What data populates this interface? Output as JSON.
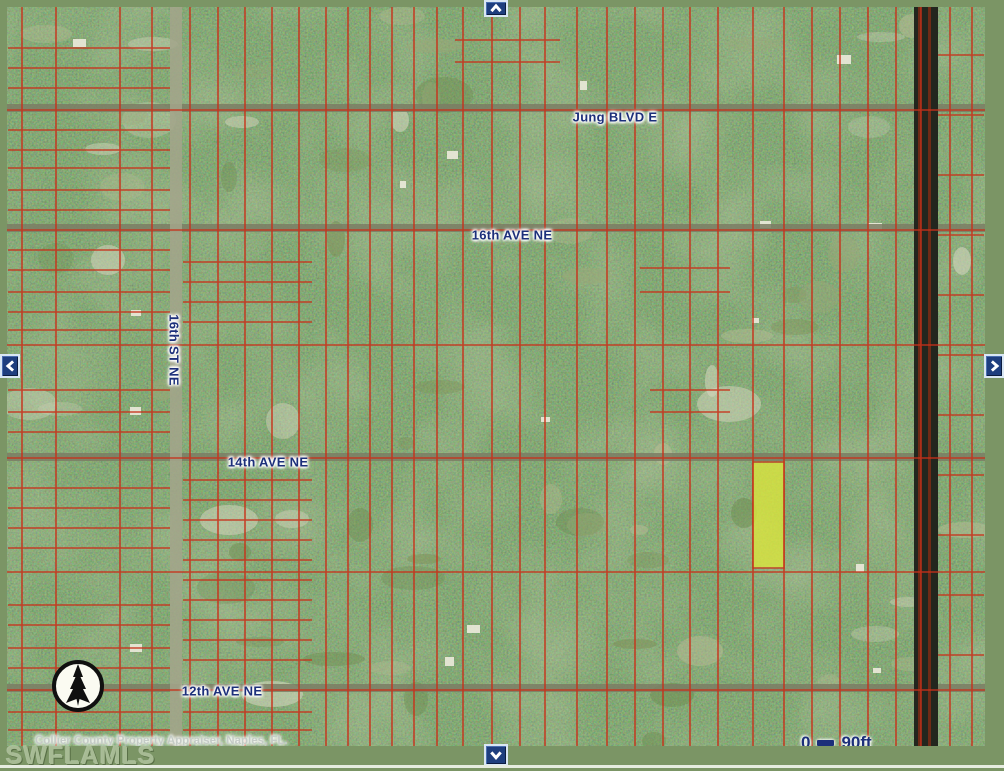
{
  "frame": {
    "border_color": "#7b9565",
    "bottom_strip_color": "#e6ece0"
  },
  "map": {
    "attribution": "Collier County Property Appraiser, Naples, FL.",
    "watermark": "SWFLAMLS",
    "scale": {
      "start": "0",
      "end": "90ft"
    },
    "label_color": "#1c2f7a",
    "parcel_color": "#c8311a",
    "highlight": {
      "x": 753,
      "y": 462,
      "w": 31,
      "h": 106,
      "color": "#dde73c"
    },
    "streets": [
      {
        "id": "jung-blvd-e",
        "label": "Jung BLVD E",
        "x": 615,
        "y": 117,
        "orientation": "h"
      },
      {
        "id": "16th-ave-ne",
        "label": "16th AVE NE",
        "x": 512,
        "y": 235,
        "orientation": "h"
      },
      {
        "id": "16th-st-ne",
        "label": "16th ST NE",
        "x": 174,
        "y": 350,
        "orientation": "v"
      },
      {
        "id": "14th-ave-ne",
        "label": "14th AVE NE",
        "x": 268,
        "y": 462,
        "orientation": "h"
      },
      {
        "id": "12th-ave-ne",
        "label": "12th AVE NE",
        "x": 222,
        "y": 691,
        "orientation": "h"
      }
    ],
    "roads": {
      "minor_vertical": {
        "x": 170,
        "w": 12
      },
      "major_vertical": {
        "x": 914,
        "w": 24
      },
      "avenues_y": [
        104,
        224,
        453,
        684
      ]
    },
    "grid": {
      "v_lines": [
        22,
        56,
        120,
        152,
        190,
        218,
        245,
        272,
        299,
        326,
        348,
        370,
        392,
        414,
        437,
        463,
        492,
        520,
        545,
        577,
        607,
        635,
        663,
        690,
        718,
        753,
        784,
        812,
        840,
        868,
        896,
        921,
        950,
        972
      ],
      "h_lines_full": [
        110,
        230,
        345,
        458,
        572,
        690
      ],
      "h_lines_partial": [
        [
          48,
          8,
          170
        ],
        [
          68,
          8,
          170
        ],
        [
          88,
          8,
          170
        ],
        [
          130,
          8,
          170
        ],
        [
          150,
          8,
          170
        ],
        [
          168,
          8,
          170
        ],
        [
          190,
          8,
          170
        ],
        [
          210,
          8,
          170
        ],
        [
          250,
          8,
          170
        ],
        [
          270,
          8,
          170
        ],
        [
          292,
          8,
          170
        ],
        [
          312,
          8,
          170
        ],
        [
          330,
          8,
          170
        ],
        [
          390,
          8,
          170
        ],
        [
          412,
          8,
          170
        ],
        [
          432,
          8,
          170
        ],
        [
          488,
          8,
          170
        ],
        [
          508,
          8,
          170
        ],
        [
          528,
          8,
          170
        ],
        [
          548,
          8,
          170
        ],
        [
          605,
          8,
          170
        ],
        [
          625,
          8,
          170
        ],
        [
          648,
          8,
          170
        ],
        [
          668,
          8,
          170
        ],
        [
          712,
          8,
          170
        ],
        [
          730,
          8,
          170
        ],
        [
          262,
          183,
          312
        ],
        [
          282,
          183,
          312
        ],
        [
          302,
          183,
          312
        ],
        [
          322,
          183,
          312
        ],
        [
          480,
          183,
          312
        ],
        [
          500,
          183,
          312
        ],
        [
          520,
          183,
          312
        ],
        [
          540,
          183,
          312
        ],
        [
          560,
          183,
          312
        ],
        [
          580,
          183,
          312
        ],
        [
          600,
          183,
          312
        ],
        [
          620,
          183,
          312
        ],
        [
          640,
          183,
          312
        ],
        [
          660,
          183,
          312
        ],
        [
          712,
          183,
          312
        ],
        [
          730,
          183,
          312
        ],
        [
          40,
          455,
          560
        ],
        [
          62,
          455,
          560
        ],
        [
          268,
          640,
          730
        ],
        [
          292,
          640,
          730
        ],
        [
          390,
          650,
          730
        ],
        [
          412,
          650,
          730
        ],
        [
          55,
          938,
          984
        ],
        [
          115,
          938,
          984
        ],
        [
          175,
          938,
          984
        ],
        [
          235,
          938,
          984
        ],
        [
          295,
          938,
          984
        ],
        [
          355,
          938,
          984
        ],
        [
          415,
          938,
          984
        ],
        [
          475,
          938,
          984
        ],
        [
          535,
          938,
          984
        ],
        [
          595,
          938,
          984
        ],
        [
          655,
          938,
          984
        ]
      ]
    }
  }
}
